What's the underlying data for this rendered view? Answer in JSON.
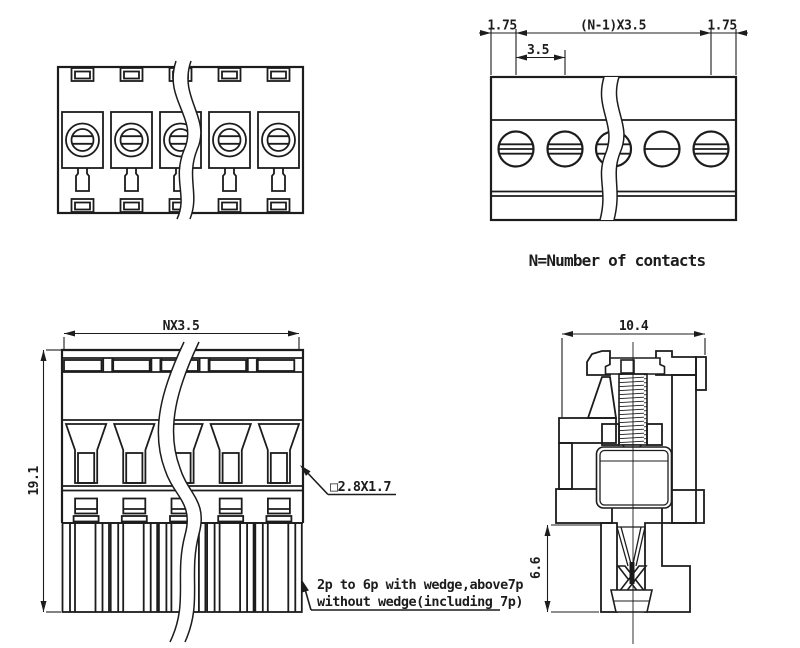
{
  "colors": {
    "line": "#1c1c1c",
    "background": "#ffffff"
  },
  "top_plan": {
    "dim_margin_left": "1.75",
    "dim_span": "(N-1)X3.5",
    "dim_margin_right": "1.75",
    "dim_pitch": "3.5",
    "note": "N=Number of contacts"
  },
  "socket_front": {
    "dim_width": "NX3.5",
    "dim_height": "19.1",
    "square_note": "□2.8X1.7",
    "wedge_note_line1": "2p to 6p with wedge,above7p",
    "wedge_note_line2": "without wedge(including 7p)"
  },
  "side_section": {
    "dim_width": "10.4",
    "dim_height": "6.6"
  }
}
